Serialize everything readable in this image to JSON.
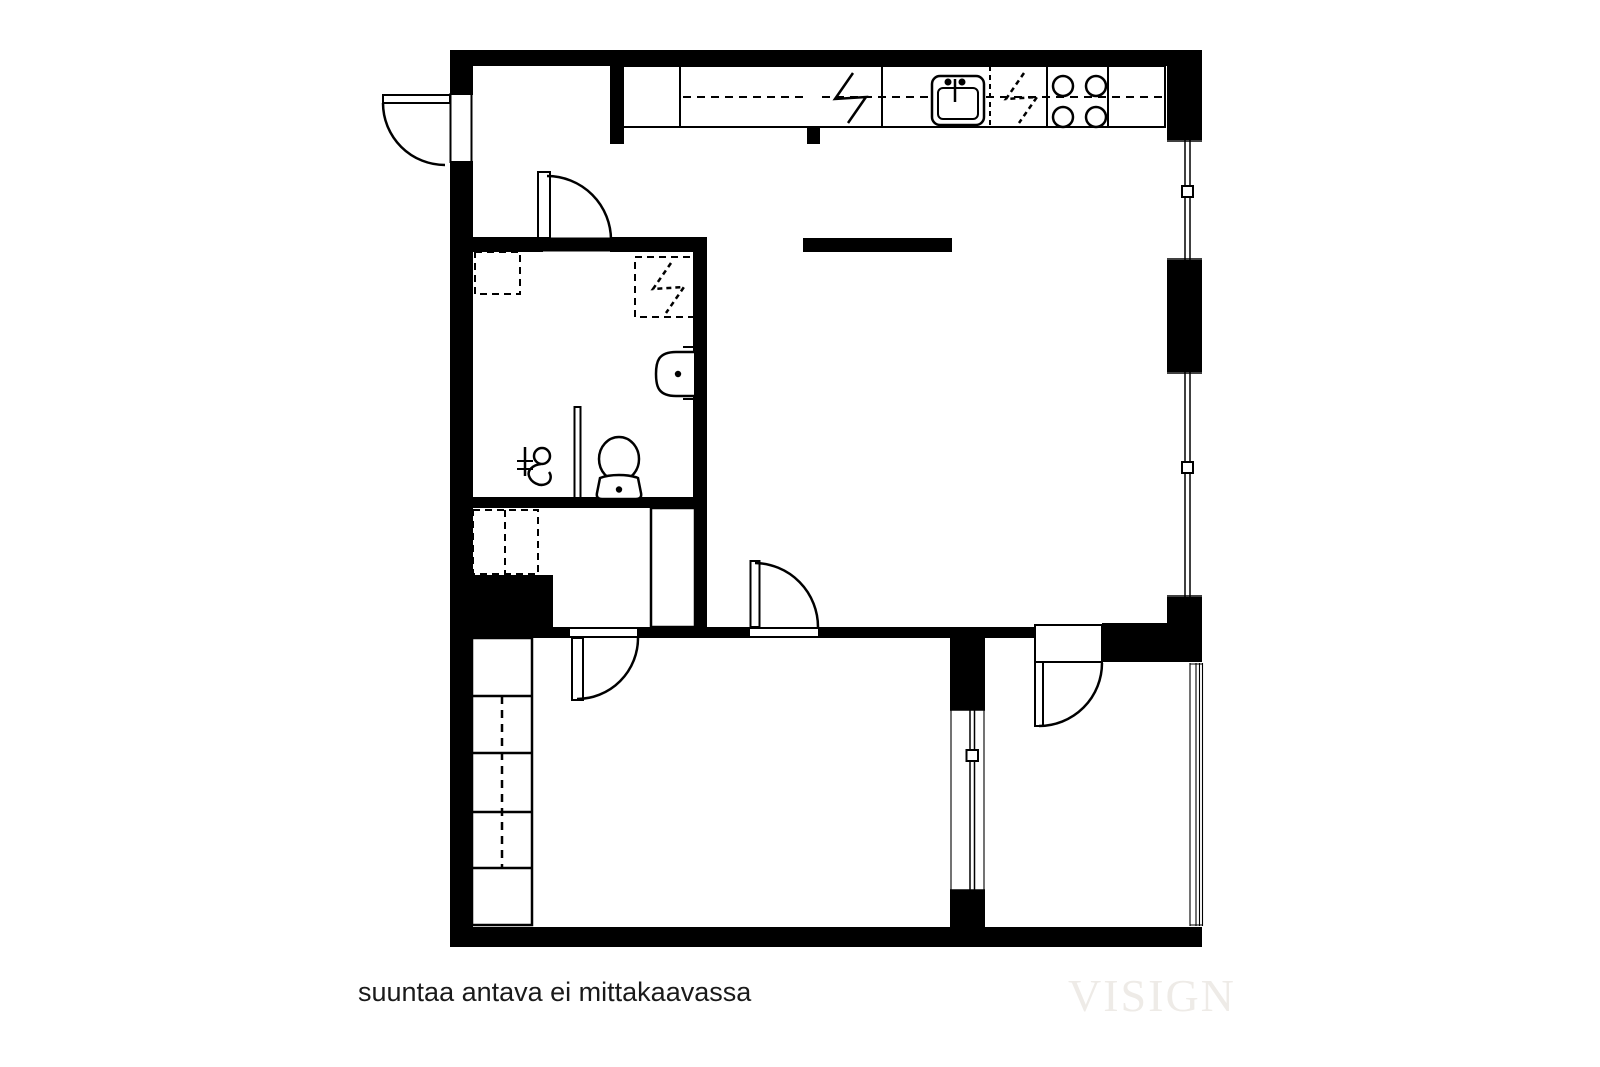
{
  "plan": {
    "type": "apartment-floor-plan",
    "footer_note": "suuntaa antava ei mittakaavassa",
    "watermark": "VISIGN",
    "fixtures": [
      "entry-door-icon",
      "interior-door-icon",
      "kitchen-counter-icon",
      "electrical-appliance-bolt-icon",
      "kitchen-sink-icon",
      "dishwasher-dashed-bolt-icon",
      "stove-burners-icon",
      "upper-cabinet-dashed-line-icon",
      "washing-machine-reservation-icon",
      "dryer-reservation-dashed-bolt-icon",
      "wall-sink-icon",
      "shower-mixer-icon",
      "shower-screen-icon",
      "toilet-icon",
      "hall-closet-reservation-icon",
      "duct-shaft-icon",
      "wardrobe-cells-icon",
      "window-icon",
      "interior-window-icon",
      "partition-bar-icon"
    ]
  },
  "colors": {
    "wall": "#000000",
    "bg": "#ffffff",
    "note": "#1a1a1a",
    "watermark": "#eeebe7"
  }
}
